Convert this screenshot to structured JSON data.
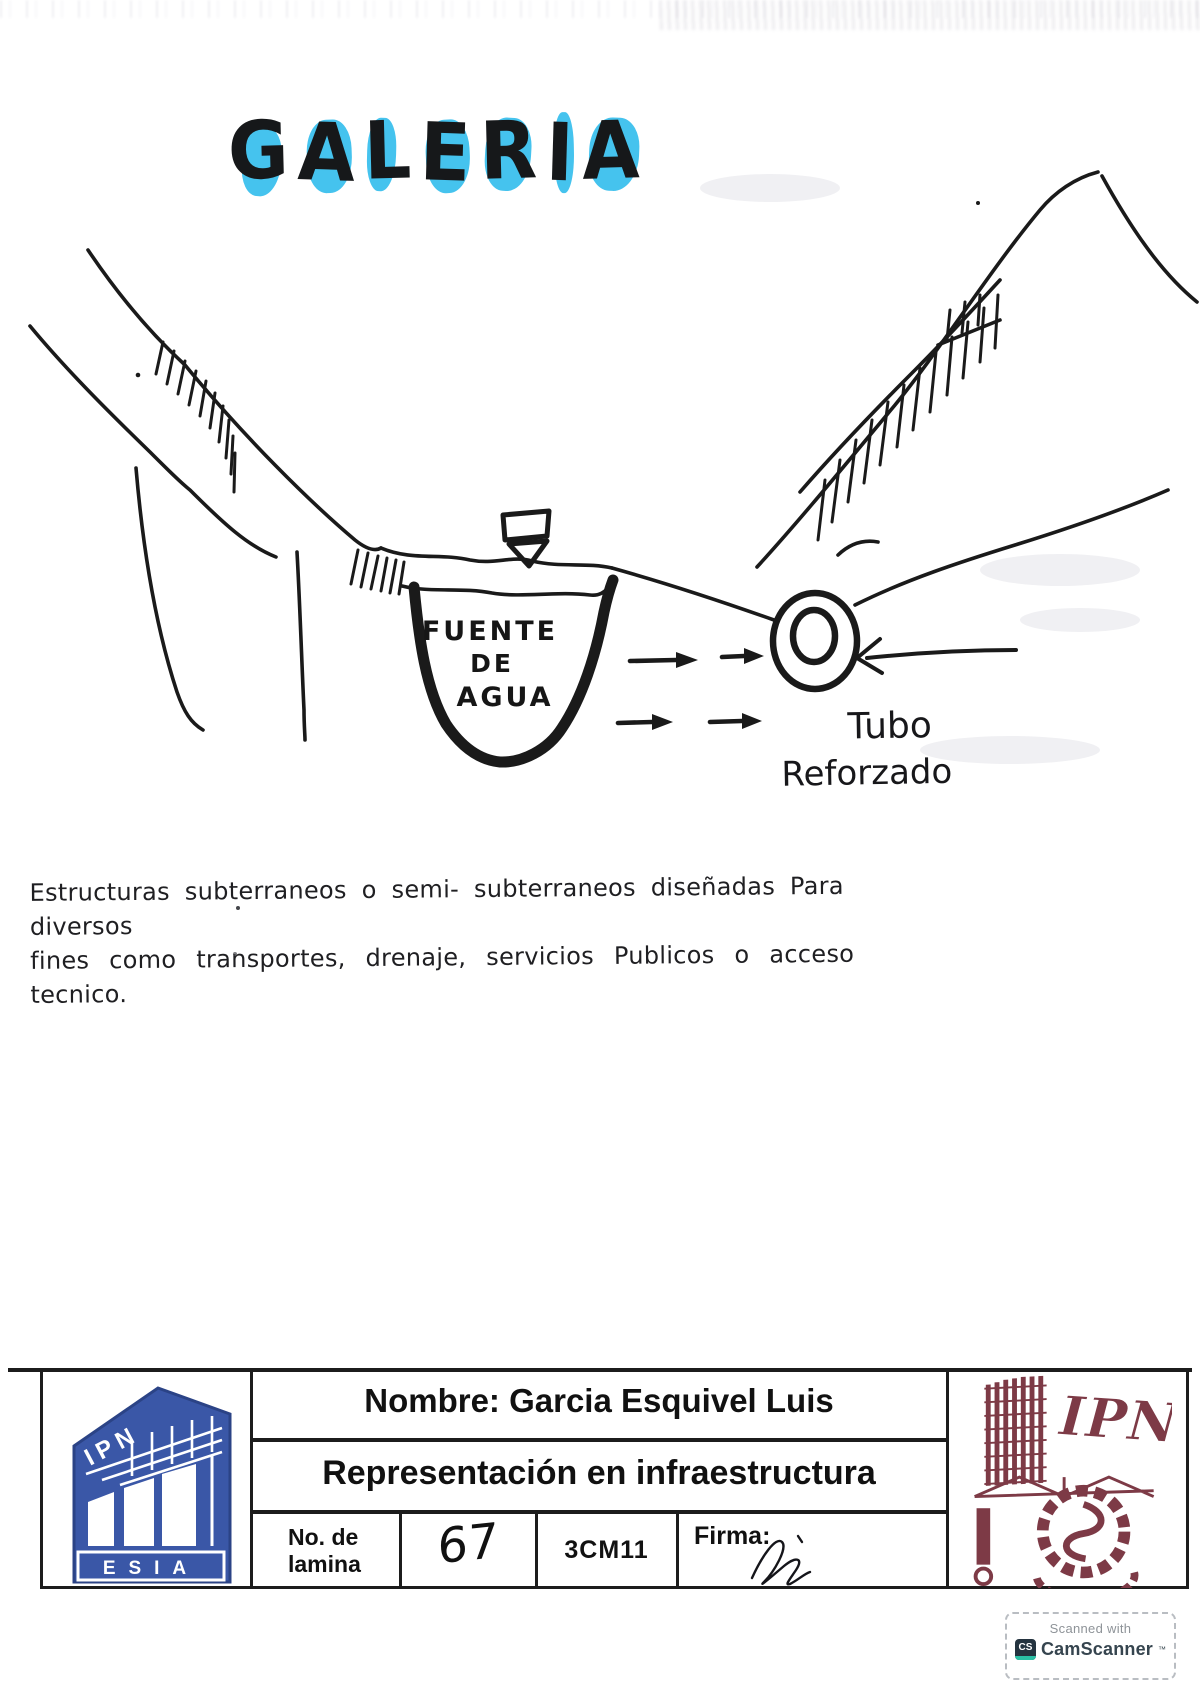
{
  "title": {
    "text": "GALERIA"
  },
  "diagram": {
    "labels": {
      "fuente_line1": "FUENTE",
      "fuente_line2": "DE",
      "fuente_line3": "AGUA",
      "tubo_line1": "Tubo",
      "tubo_line2": "Reforzado"
    }
  },
  "note": {
    "line1": "Estructuras subterraneos o semi- subterraneos diseñadas Para diversos",
    "line2": "fines como transportes, drenaje, servicios Publicos o acceso tecnico."
  },
  "title_block": {
    "name_row": "Nombre: Garcia Esquivel Luis",
    "subject_row": "Representación en infraestructura",
    "sheet_label_line1": "No. de",
    "sheet_label_line2": "lamina",
    "sheet_number": "67",
    "group_code": "3CM11",
    "signature_label": "Firma:",
    "esia_logo": {
      "top_text": "IPN",
      "bottom_text": "ESIA"
    },
    "ipn_logo": {
      "text": "IPN"
    }
  },
  "scanner_badge": {
    "line1": "Scanned with",
    "logo_text": "CS",
    "brand": "CamScanner",
    "tm": "™"
  },
  "colors": {
    "ink": "#1a1a1a",
    "highlight_cyan": "#45c3ee",
    "esia_blue": "#3a57a7",
    "ipn_maroon": "#7d3a46",
    "badge_teal": "#2bc0a5"
  }
}
